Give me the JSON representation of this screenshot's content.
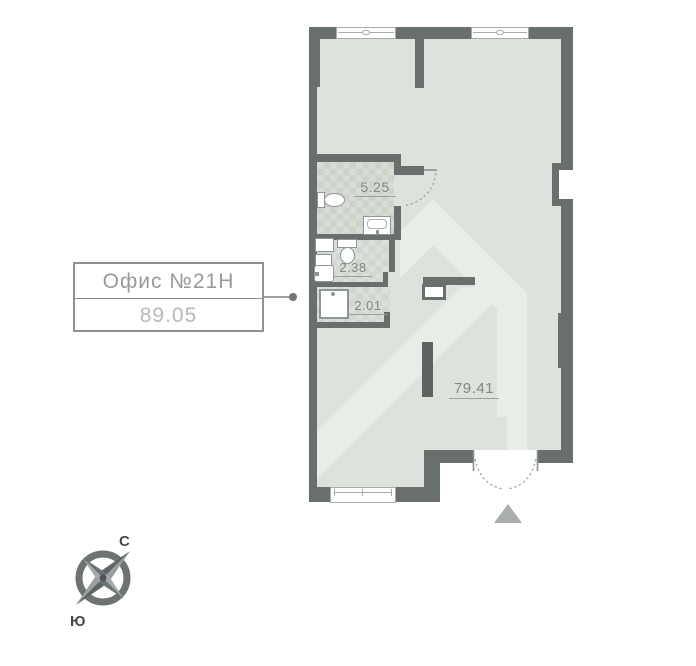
{
  "plan": {
    "unit_label": {
      "title": "Офис №21Н",
      "area": "89.05"
    },
    "rooms": [
      {
        "id": "bathroom",
        "area": "5.25"
      },
      {
        "id": "wc",
        "area": "2.38"
      },
      {
        "id": "shower-room",
        "area": "2.01"
      },
      {
        "id": "main-space",
        "area": "79.41"
      }
    ],
    "compass": {
      "north": "С",
      "south": "Ю"
    },
    "colors": {
      "wall": "#696f6d",
      "floor": "#dde2dc",
      "tile": "#d7ddd5",
      "watermark": "#e9ede8",
      "outside": "#ffffff",
      "area_text": "#7f8885",
      "box_title_text": "#959b98",
      "box_area_text": "#b5bab7"
    }
  }
}
